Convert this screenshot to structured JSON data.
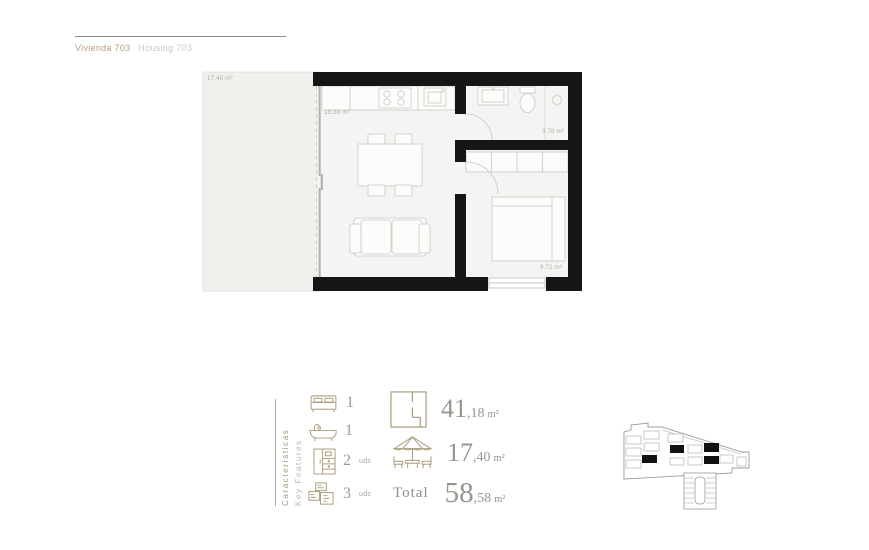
{
  "header": {
    "title_primary": "Vivienda 703",
    "title_secondary": "Housing 703"
  },
  "floorplan": {
    "terrace_label": "17.40 m²",
    "living_label": "18.36 m²",
    "bathroom_label": "3.78 m²",
    "bedroom_label": "9.72 m²"
  },
  "features": {
    "title_es": "Características",
    "title_en": "Key Features",
    "counts": [
      {
        "icon": "bed-icon",
        "value": "1",
        "suffix": ""
      },
      {
        "icon": "bathtub-icon",
        "value": "1",
        "suffix": ""
      },
      {
        "icon": "wardrobe-icon",
        "value": "2",
        "suffix": "uds"
      },
      {
        "icon": "rooms-icon",
        "value": "3",
        "suffix": "uds"
      }
    ],
    "areas": [
      {
        "icon": "floorplan-icon",
        "int": "41",
        "dec": ",18",
        "unit": "m²"
      },
      {
        "icon": "pergola-icon",
        "int": "17",
        "dec": ",40",
        "unit": "m²"
      }
    ],
    "total_label": "Total",
    "total": {
      "int": "58",
      "dec": ",58",
      "unit": "m²"
    }
  },
  "colors": {
    "accent": "#a79b78",
    "number": "#97958d",
    "wall": "#161616"
  }
}
